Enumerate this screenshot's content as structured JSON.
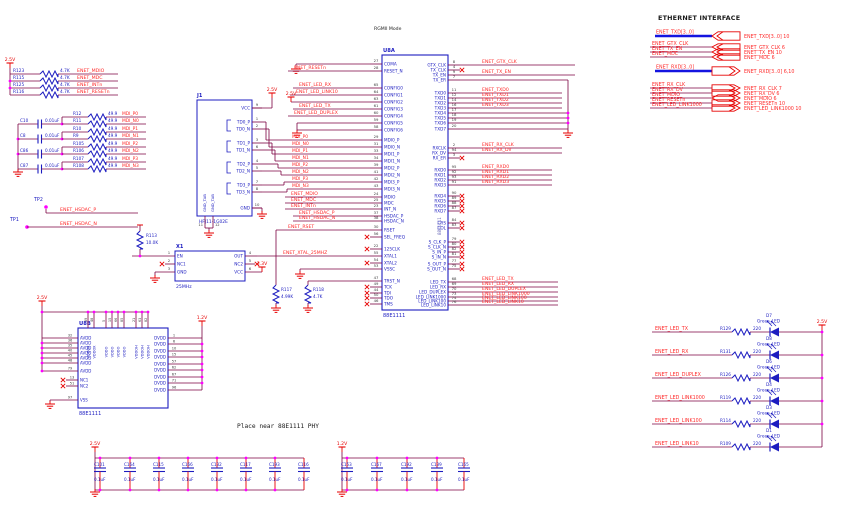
{
  "labels": {
    "ethernet_interface_title": "ETHERNET INTERFACE",
    "rgmii_mode": "RGMII Mode",
    "place_near_note": "Place near 88E1111 PHY"
  },
  "colors": {
    "wire": "#7c0041",
    "component": "#1c1cc0",
    "net_label": "#ff2a2a",
    "power": "#e60000",
    "junction": "#ff00ff",
    "pin_number": "#3c3c3c",
    "bus": "#1414e0",
    "part_gray": "#6a6ab8"
  },
  "pullups": {
    "rail": "2.5V",
    "value": "4.7K",
    "rows": [
      {
        "ref": "R123",
        "net": "ENET_MDIO"
      },
      {
        "ref": "R115",
        "net": "ENET_MDC"
      },
      {
        "ref": "R125",
        "net": "ENET_INTn"
      },
      {
        "ref": "R116",
        "net": "ENET_RESETn"
      }
    ]
  },
  "mdi": {
    "cap_value": "0.01uF",
    "res_value": "49.9",
    "caps": [
      "C10",
      "C8",
      "C86",
      "C87"
    ],
    "resistors": [
      {
        "ref": "R12",
        "net": "MDI_P0"
      },
      {
        "ref": "R11",
        "net": "MDI_N0"
      },
      {
        "ref": "R10",
        "net": "MDI_P1"
      },
      {
        "ref": "R9",
        "net": "MDI_N1"
      },
      {
        "ref": "R105",
        "net": "MDI_P2"
      },
      {
        "ref": "R106",
        "net": "MDI_N2"
      },
      {
        "ref": "R107",
        "net": "MDI_P3"
      },
      {
        "ref": "R108",
        "net": "MDI_N3"
      }
    ]
  },
  "testpoints": {
    "tp1": "TP1",
    "tp2": "TP2",
    "net_p": "ENET_HSDAC_P",
    "net_n": "ENET_HSDAC_N"
  },
  "j1": {
    "ref": "J1",
    "part": "HFJ11-1G02E",
    "vcc_rail": "2.5V",
    "tab_name": "GND_TAB",
    "tab_pins": [
      "11",
      "12"
    ],
    "pins": [
      {
        "n": "9",
        "name": "VCC"
      },
      {
        "n": "1",
        "name": "TD0_P"
      },
      {
        "n": "2",
        "name": "TD0_N"
      },
      {
        "n": "3",
        "name": "TD1_P"
      },
      {
        "n": "6",
        "name": "TD1_N"
      },
      {
        "n": "4",
        "name": "TD2_P"
      },
      {
        "n": "5",
        "name": "TD2_N"
      },
      {
        "n": "7",
        "name": "TD3_P"
      },
      {
        "n": "8",
        "name": "TD3_N"
      },
      {
        "n": "10",
        "name": "GND"
      }
    ]
  },
  "x1": {
    "ref": "X1",
    "freq": "25MHz",
    "vcc_rail": "3.3V",
    "left_pins": [
      {
        "n": "1",
        "name": "EN"
      },
      {
        "n": "2",
        "name": "NC1",
        "nc": true
      },
      {
        "n": "3",
        "name": "GND"
      }
    ],
    "right_pins": [
      {
        "n": "4",
        "name": "OUT"
      },
      {
        "n": "5",
        "name": "NC2",
        "nc": true
      },
      {
        "n": "6",
        "name": "VCC"
      }
    ]
  },
  "r113": {
    "ref": "R113",
    "value": "10.0K"
  },
  "r117": {
    "ref": "R117",
    "value": "4.99K"
  },
  "r118": {
    "ref": "R118",
    "value": "4.7K"
  },
  "u8a": {
    "ref": "U8A",
    "part": "88E1111",
    "xtal_net": "ENET_XTAL_25MHZ",
    "rset_net": "ENET_RSET",
    "config2_rail": "2.5V",
    "left_pins": [
      {
        "n": "27",
        "name": "COMA"
      },
      {
        "n": "28",
        "name": "RESET_N",
        "net": "ENET_RESETn"
      },
      {
        "n": "65",
        "name": "CONFIG0",
        "net": "ENET_LED_RX"
      },
      {
        "n": "64",
        "name": "CONFIG1",
        "net": "ENET_LED_LINK10"
      },
      {
        "n": "63",
        "name": "CONFIG2"
      },
      {
        "n": "61",
        "name": "CONFIG3",
        "net": "ENET_LED_TX"
      },
      {
        "n": "60",
        "name": "CONFIG4",
        "net": "ENET_LED_DUPLEX"
      },
      {
        "n": "59",
        "name": "CONFIG5"
      },
      {
        "n": "58",
        "name": "CONFIG6"
      },
      {
        "n": "29",
        "name": "MDI0_P",
        "net": "MDI_P0"
      },
      {
        "n": "31",
        "name": "MDI0_N",
        "net": "MDI_N0"
      },
      {
        "n": "33",
        "name": "MDI1_P",
        "net": "MDI_P1"
      },
      {
        "n": "34",
        "name": "MDI1_N",
        "net": "MDI_N1"
      },
      {
        "n": "39",
        "name": "MDI2_P",
        "net": "MDI_P2"
      },
      {
        "n": "41",
        "name": "MDI2_N",
        "net": "MDI_N2"
      },
      {
        "n": "42",
        "name": "MDI3_P",
        "net": "MDI_P3"
      },
      {
        "n": "43",
        "name": "MDI3_N",
        "net": "MDI_N3"
      },
      {
        "n": "24",
        "name": "MDIO",
        "net": "ENET_MDIO"
      },
      {
        "n": "25",
        "name": "MDC",
        "net": "ENET_MDC"
      },
      {
        "n": "23",
        "name": "INT_N",
        "net": "ENET_INTn"
      },
      {
        "n": "37",
        "name": "HSDAC_P",
        "net": "ENET_HSDAC_P"
      },
      {
        "n": "38",
        "name": "HSDAC_N",
        "net": "ENET_HSDAC_N"
      },
      {
        "n": "30",
        "name": "RSET",
        "net": "ENET_RSET"
      },
      {
        "n": "56",
        "name": "SEL_FREQ",
        "nc": true
      },
      {
        "n": "22",
        "name": "125CLK",
        "nc": true
      },
      {
        "n": "55",
        "name": "XTAL1"
      },
      {
        "n": "54",
        "name": "XTAL2",
        "nc": true
      },
      {
        "n": "53",
        "name": "VSSC"
      },
      {
        "n": "47",
        "name": "TRST_N"
      },
      {
        "n": "49",
        "name": "TCK",
        "nc": true
      },
      {
        "n": "44",
        "name": "TDI",
        "nc": true
      },
      {
        "n": "50",
        "name": "TDO",
        "nc": true
      },
      {
        "n": "46",
        "name": "TMS",
        "nc": true
      }
    ],
    "right_pins": [
      {
        "n": "8",
        "name": "GTX_CLK",
        "net": "ENET_GTX_CLK"
      },
      {
        "n": "4",
        "name": "TX_CLK",
        "nc": true
      },
      {
        "n": "9",
        "name": "TX_EN",
        "net": "ENET_TX_EN"
      },
      {
        "n": "7",
        "name": "TX_ER",
        "gnd": true
      },
      {
        "n": "11",
        "name": "TXD0",
        "net": "ENET_TXD0"
      },
      {
        "n": "12",
        "name": "TXD1",
        "net": "ENET_TXD1"
      },
      {
        "n": "14",
        "name": "TXD2",
        "net": "ENET_TXD2"
      },
      {
        "n": "16",
        "name": "TXD3",
        "net": "ENET_TXD3"
      },
      {
        "n": "17",
        "name": "TXD4",
        "gnd": true
      },
      {
        "n": "18",
        "name": "TXD5",
        "gnd": true
      },
      {
        "n": "19",
        "name": "TXD6",
        "gnd": true
      },
      {
        "n": "20",
        "name": "TXD7",
        "gnd": true
      },
      {
        "n": "2",
        "name": "RXCLK",
        "net": "ENET_RX_CLK"
      },
      {
        "n": "94",
        "name": "RX_DV",
        "net": "ENET_RX_DV"
      },
      {
        "n": "3",
        "name": "RX_ER",
        "nc": true
      },
      {
        "n": "95",
        "name": "RXD0",
        "net": "ENET_RXD0"
      },
      {
        "n": "92",
        "name": "RXD1",
        "net": "ENET_RXD1"
      },
      {
        "n": "93",
        "name": "RXD2",
        "net": "ENET_RXD2"
      },
      {
        "n": "91",
        "name": "RXD3",
        "net": "ENET_RXD3"
      },
      {
        "n": "90",
        "name": "RXD4",
        "nc": true
      },
      {
        "n": "89",
        "name": "RXD5",
        "nc": true
      },
      {
        "n": "88",
        "name": "RXD6",
        "nc": true
      },
      {
        "n": "87",
        "name": "RXD7",
        "nc": true
      },
      {
        "n": "84",
        "name": "CRS",
        "nc": true
      },
      {
        "n": "83",
        "name": "COL",
        "nc": true
      },
      {
        "n": "79",
        "name": "S_CLK_P",
        "nc": true
      },
      {
        "n": "80",
        "name": "S_CLK_N",
        "nc": true
      },
      {
        "n": "82",
        "name": "S_IN_P",
        "nc": true
      },
      {
        "n": "81",
        "name": "S_IN_N",
        "nc": true
      },
      {
        "n": "77",
        "name": "S_OUT_P",
        "nc": true
      },
      {
        "n": "75",
        "name": "S_OUT_N",
        "nc": true
      },
      {
        "n": "68",
        "name": "LED_TX",
        "net": "ENET_LED_TX"
      },
      {
        "n": "69",
        "name": "LED_RX",
        "net": "ENET_LED_RX"
      },
      {
        "n": "70",
        "name": "LED_DUPLEX",
        "net": "ENET_LED_DUPLEX"
      },
      {
        "n": "73",
        "name": "LED_LINK1000",
        "net": "ENET_LED_LINK1000"
      },
      {
        "n": "74",
        "name": "LED_LINK100",
        "net": "ENET_LED_LINK100"
      },
      {
        "n": "76",
        "name": "LED_LINK10",
        "net": "ENET_LED_LINK10"
      }
    ]
  },
  "u8b": {
    "ref": "U8B",
    "part": "88E1111",
    "left_rail": "2.5V",
    "right_rail": "1.2V",
    "avdd_pins": [
      {
        "n": "32",
        "name": "AVDD"
      },
      {
        "n": "36",
        "name": "AVDD"
      },
      {
        "n": "35",
        "name": "AVDD"
      },
      {
        "n": "40",
        "name": "AVDD"
      },
      {
        "n": "45",
        "name": "AVDD"
      },
      {
        "n": "48",
        "name": "AVDD"
      },
      {
        "n": "79",
        "name": "AVDD"
      }
    ],
    "nc_pins": [
      {
        "n": "13",
        "name": "NC1"
      },
      {
        "n": "51",
        "name": "NC2"
      }
    ],
    "vss_pin": {
      "n": "97",
      "name": "VSS"
    },
    "top_pins": [
      {
        "n": "39",
        "name": "VDDOX"
      },
      {
        "n": "48",
        "name": "VDDOX"
      },
      {
        "n": "5",
        "name": "VDDO"
      },
      {
        "n": "15",
        "name": "VDDO"
      },
      {
        "n": "66",
        "name": "VDDO"
      },
      {
        "n": "85",
        "name": "VDDO"
      },
      {
        "n": "21",
        "name": "VDDOH"
      },
      {
        "n": "63",
        "name": "VDDOH"
      },
      {
        "n": "82",
        "name": "VDDOH"
      }
    ],
    "dvdd_pins": [
      {
        "n": "1",
        "name": "DVDD"
      },
      {
        "n": "6",
        "name": "DVDD"
      },
      {
        "n": "10",
        "name": "DVDD"
      },
      {
        "n": "15",
        "name": "DVDD"
      },
      {
        "n": "57",
        "name": "DVDD"
      },
      {
        "n": "62",
        "name": "DVDD"
      },
      {
        "n": "67",
        "name": "DVDD"
      },
      {
        "n": "71",
        "name": "DVDD"
      },
      {
        "n": "96",
        "name": "DVDD"
      }
    ]
  },
  "cap_banks": [
    {
      "rail": "2.5V",
      "value": "0.1uF",
      "caps": [
        "C101",
        "C164",
        "C115",
        "C166",
        "C132",
        "C117",
        "C193",
        "C116"
      ]
    },
    {
      "rail": "1.2V",
      "value": "0.1uF",
      "caps": [
        "C153",
        "C167",
        "C192",
        "C139",
        "C165"
      ]
    }
  ],
  "interface": {
    "rows": [
      {
        "kind": "bus_in",
        "net": "ENET_TXD[3..0]",
        "ref": "ENET_TXD[3..0] 10"
      },
      {
        "kind": "in",
        "net": "ENET_GTX_CLK",
        "ref": "ENET_GTX_CLK 6"
      },
      {
        "kind": "in",
        "net": "ENET_TX_EN",
        "ref": "ENET_TX_EN 10"
      },
      {
        "kind": "in",
        "net": "ENET_MDC",
        "ref": "ENET_MDC 6"
      },
      {
        "kind": "bus_out",
        "net": "ENET_RXD[3..0]",
        "ref": "ENET_RXD[3..0] 6,10"
      },
      {
        "kind": "out",
        "net": "ENET_RX_CLK",
        "ref": "ENET_RX_CLK 7"
      },
      {
        "kind": "out",
        "net": "ENET_RX_DV",
        "ref": "ENET_RX_DV 6"
      },
      {
        "kind": "bidir",
        "net": "ENET_MDIO",
        "ref": "ENET_MDIO 6"
      },
      {
        "kind": "out",
        "net": "ENET_RESETn",
        "ref": "ENET_RESETn 10"
      },
      {
        "kind": "out",
        "net": "ENET_LED_LINK1000",
        "ref": "ENET_LED_LINK1000 10"
      }
    ]
  },
  "leds": {
    "rail": "2.5V",
    "value": "220",
    "type": "Green_LED",
    "rows": [
      {
        "net": "ENET_LED_TX",
        "res": "R129",
        "d": "D7"
      },
      {
        "net": "ENET_LED_RX",
        "res": "R131",
        "d": "D8"
      },
      {
        "net": "ENET_LED_DUPLEX",
        "res": "R126",
        "d": "D6"
      },
      {
        "net": "ENET_LED_LINK1000",
        "res": "R119",
        "d": "D4"
      },
      {
        "net": "ENET_LED_LINK100",
        "res": "R114",
        "d": "D3"
      },
      {
        "net": "ENET_LED_LINK10",
        "res": "R109",
        "d": "D1"
      }
    ]
  }
}
